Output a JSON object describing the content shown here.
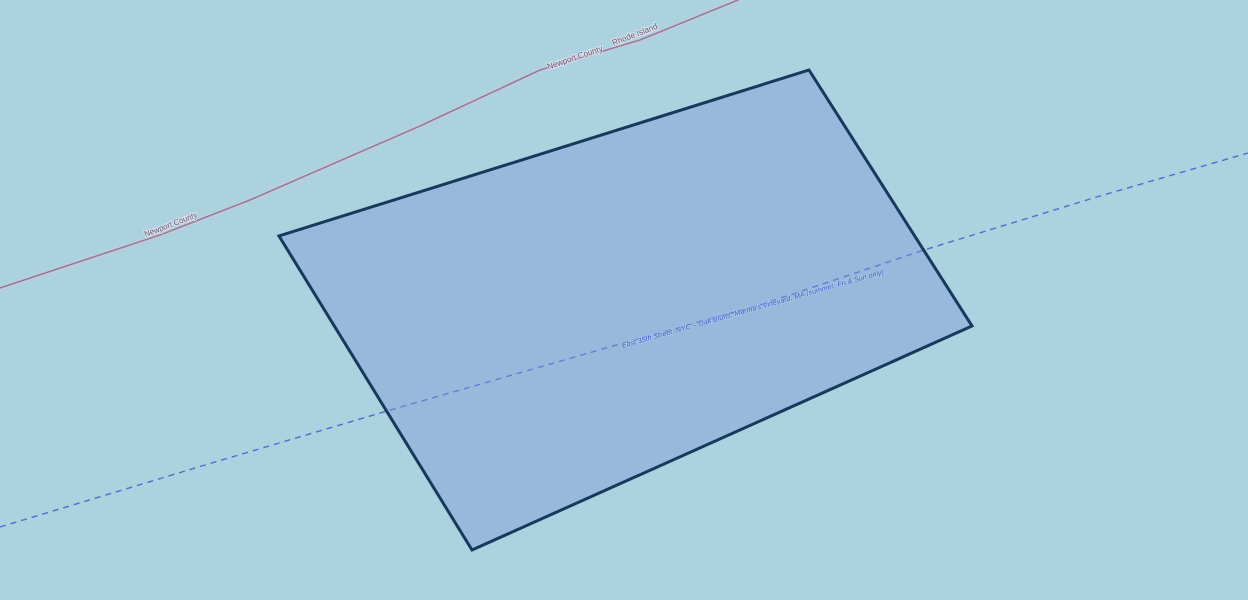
{
  "map": {
    "water_color": "#abd2de",
    "selected_polygon": {
      "fill": "rgba(129,149,218,0.42)",
      "stroke": "#17395c"
    },
    "ferry_route": {
      "label": "East 35th Street, NYC – Oak Bluffs, Martha's Vineyard, MA (summer; Fri & Sun only)",
      "line_color": "#4d66cc",
      "label_color": "#3757c4"
    },
    "admin_boundary": {
      "line_color": "#8e7f9b",
      "label_color": "#77507a",
      "labels": [
        "Newport County",
        "Rhode Island",
        "Newport County"
      ]
    }
  }
}
